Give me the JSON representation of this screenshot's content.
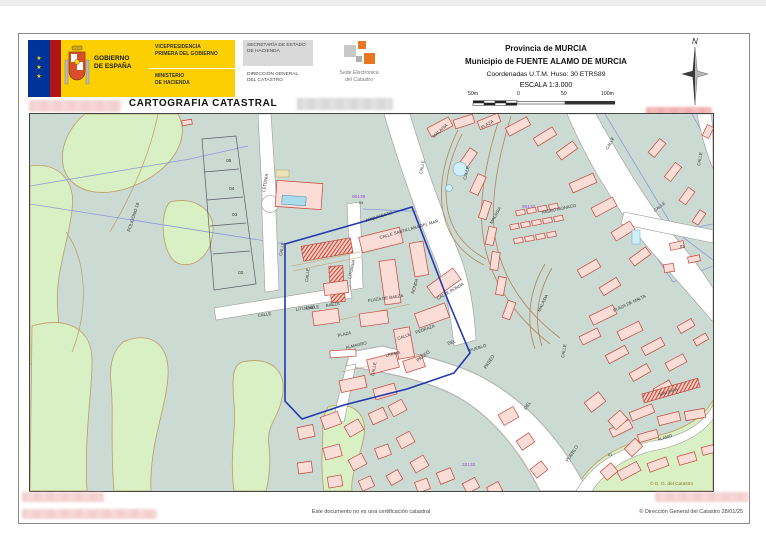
{
  "document": {
    "title": "CARTOGRAFIA CATASTRAL",
    "disclaimer": "Este documento no es una certificación catastral",
    "copyright": "© Dirección General del Catastro 28/01/25"
  },
  "logo": {
    "stars": "★\n★\n★",
    "gobierno": "GOBIERNO\nDE ESPAÑA",
    "dept_top": "VICEPRESIDENCIA\nPRIMERA DEL GOBIERNO",
    "dept_bottom": "MINISTERIO\nDE HACIENDA",
    "secretaria": "SECRETARÍA DE ESTADO\nDE HACIENDA",
    "direccion": "DIRECCIÓN GENERAL\nDEL CATASTRO",
    "sede": "Sede Electrónica\ndel Catastro"
  },
  "title_block": {
    "province": "Provincia de MURCIA",
    "municipality": "Municipio de FUENTE ALAMO DE MURCIA",
    "coords": "Coordenadas U.T.M. Huso: 30 ETRS89",
    "scale": "ESCALA 1:3.000",
    "scale_ticks": {
      "t1": "50m",
      "t2": "0",
      "t3": "50",
      "t4": "100m"
    },
    "north": "N"
  },
  "map": {
    "colors": {
      "base_teal": "#cbdad3",
      "green": "#d9efc4",
      "green_edge": "#bd9d62",
      "building_fill": "#f9ddd6",
      "building_stroke": "#c4453a",
      "boundary_blue": "#2438ae",
      "parcel_blue": "#8d9bd6",
      "ref_purple": "#9a4fd0",
      "road_white": "#ffffff"
    },
    "labels": [
      {
        "t": "POLIGONO 19",
        "x": 100,
        "y": 118,
        "r": -72,
        "s": 4.5
      },
      {
        "t": "05",
        "x": 196,
        "y": 48,
        "s": 4.8
      },
      {
        "t": "04",
        "x": 199,
        "y": 76,
        "s": 4.8
      },
      {
        "t": "03",
        "x": 202,
        "y": 102,
        "s": 4.8
      },
      {
        "t": "02",
        "x": 208,
        "y": 160,
        "s": 4.8
      },
      {
        "t": "LETONIA",
        "x": 235,
        "y": 78,
        "r": -80,
        "s": 4.3
      },
      {
        "t": "CALLE",
        "x": 228,
        "y": 203,
        "r": -9,
        "s": 4.3
      },
      {
        "t": "LITUANIA",
        "x": 266,
        "y": 197,
        "r": -9,
        "s": 4.3
      },
      {
        "t": "LITUANIA",
        "x": 321,
        "y": 165,
        "r": -78,
        "s": 4.3
      },
      {
        "t": "90139",
        "x": 322,
        "y": 84,
        "s": 4.8,
        "c": "#9a4fd0"
      },
      {
        "t": "09",
        "x": 329,
        "y": 90,
        "s": 3.8
      },
      {
        "t": "ARQUITECTO",
        "x": 336,
        "y": 108,
        "r": -17,
        "s": 4.3
      },
      {
        "t": "CALLE SANTILLANA DEL MAR",
        "x": 350,
        "y": 125,
        "r": -16,
        "s": 4.3
      },
      {
        "t": "CALLE",
        "x": 252,
        "y": 142,
        "r": -80,
        "s": 4.3
      },
      {
        "t": "CALLE",
        "x": 278,
        "y": 168,
        "r": -84,
        "s": 4.3
      },
      {
        "t": "CALLE",
        "x": 276,
        "y": 196,
        "r": -9,
        "s": 4.3
      },
      {
        "t": "BAEZA",
        "x": 296,
        "y": 193,
        "r": -9,
        "s": 4.3
      },
      {
        "t": "PLAZA DE BAEZA",
        "x": 338,
        "y": 188,
        "r": -8,
        "s": 4.3
      },
      {
        "t": "RONDA",
        "x": 384,
        "y": 180,
        "r": -74,
        "s": 4.3
      },
      {
        "t": "CALLE RONDA",
        "x": 408,
        "y": 186,
        "r": -30,
        "s": 4.3
      },
      {
        "t": "PLAZA",
        "x": 308,
        "y": 223,
        "r": -13,
        "s": 4.3
      },
      {
        "t": "ALMAGRO",
        "x": 316,
        "y": 235,
        "r": -13,
        "s": 4.3
      },
      {
        "t": "CALLE",
        "x": 368,
        "y": 226,
        "r": -20,
        "s": 4.3
      },
      {
        "t": "PEDRAZA",
        "x": 386,
        "y": 220,
        "r": -20,
        "s": 4.3
      },
      {
        "t": "LERMA",
        "x": 356,
        "y": 243,
        "r": -13,
        "s": 4.3
      },
      {
        "t": "CALLE",
        "x": 344,
        "y": 262,
        "r": -80,
        "s": 4.3
      },
      {
        "t": "PASEO",
        "x": 388,
        "y": 248,
        "r": -38,
        "s": 4.6
      },
      {
        "t": "DEL",
        "x": 418,
        "y": 231,
        "r": -18,
        "s": 4.3
      },
      {
        "t": "PUEBLO",
        "x": 440,
        "y": 238,
        "r": -18,
        "s": 4.3
      },
      {
        "t": "PASEO",
        "x": 456,
        "y": 255,
        "r": -56,
        "s": 4.6
      },
      {
        "t": "DEL",
        "x": 496,
        "y": 296,
        "r": -56,
        "s": 4.6
      },
      {
        "t": "PUEBLO",
        "x": 538,
        "y": 348,
        "r": -56,
        "s": 4.6
      },
      {
        "t": "MALASIA",
        "x": 404,
        "y": 24,
        "r": -42,
        "s": 4.3
      },
      {
        "t": "PLAZA",
        "x": 452,
        "y": 15,
        "r": -30,
        "s": 4.3
      },
      {
        "t": "CALLE",
        "x": 436,
        "y": 66,
        "r": -76,
        "s": 4.3
      },
      {
        "t": "CALLE",
        "x": 392,
        "y": 60,
        "r": -78,
        "s": 4.3
      },
      {
        "t": "MALASIA",
        "x": 462,
        "y": 110,
        "r": -60,
        "s": 4.3
      },
      {
        "t": "PASEO MONACO",
        "x": 512,
        "y": 100,
        "r": -12,
        "s": 4.3
      },
      {
        "t": "90137",
        "x": 492,
        "y": 94,
        "s": 4.8,
        "c": "#9a4fd0"
      },
      {
        "t": "CALLE",
        "x": 578,
        "y": 36,
        "r": -62,
        "s": 4.3
      },
      {
        "t": "CALLE",
        "x": 670,
        "y": 52,
        "r": -80,
        "s": 4.3
      },
      {
        "t": "CALLE",
        "x": 625,
        "y": 98,
        "r": -38,
        "s": 4.3
      },
      {
        "t": "01",
        "x": 650,
        "y": 134,
        "s": 4.2
      },
      {
        "t": "PLAZA DE MALTA",
        "x": 584,
        "y": 198,
        "r": -25,
        "s": 4.3
      },
      {
        "t": "MALASIA",
        "x": 510,
        "y": 198,
        "r": -64,
        "s": 4.3
      },
      {
        "t": "CALLE",
        "x": 534,
        "y": 244,
        "r": -80,
        "s": 4.3
      },
      {
        "t": "MALASIA",
        "x": 630,
        "y": 282,
        "r": -18,
        "s": 4.3
      },
      {
        "t": "ALAMO",
        "x": 628,
        "y": 327,
        "r": -16,
        "s": 4.3
      },
      {
        "t": "61",
        "x": 578,
        "y": 342,
        "s": 3.8
      },
      {
        "t": "32132",
        "x": 432,
        "y": 352,
        "s": 4.8,
        "c": "#9a4fd0"
      },
      {
        "t": "© D. G. del Catastro",
        "x": 620,
        "y": 371,
        "s": 4.8,
        "c": "#8a7c1a"
      }
    ]
  }
}
